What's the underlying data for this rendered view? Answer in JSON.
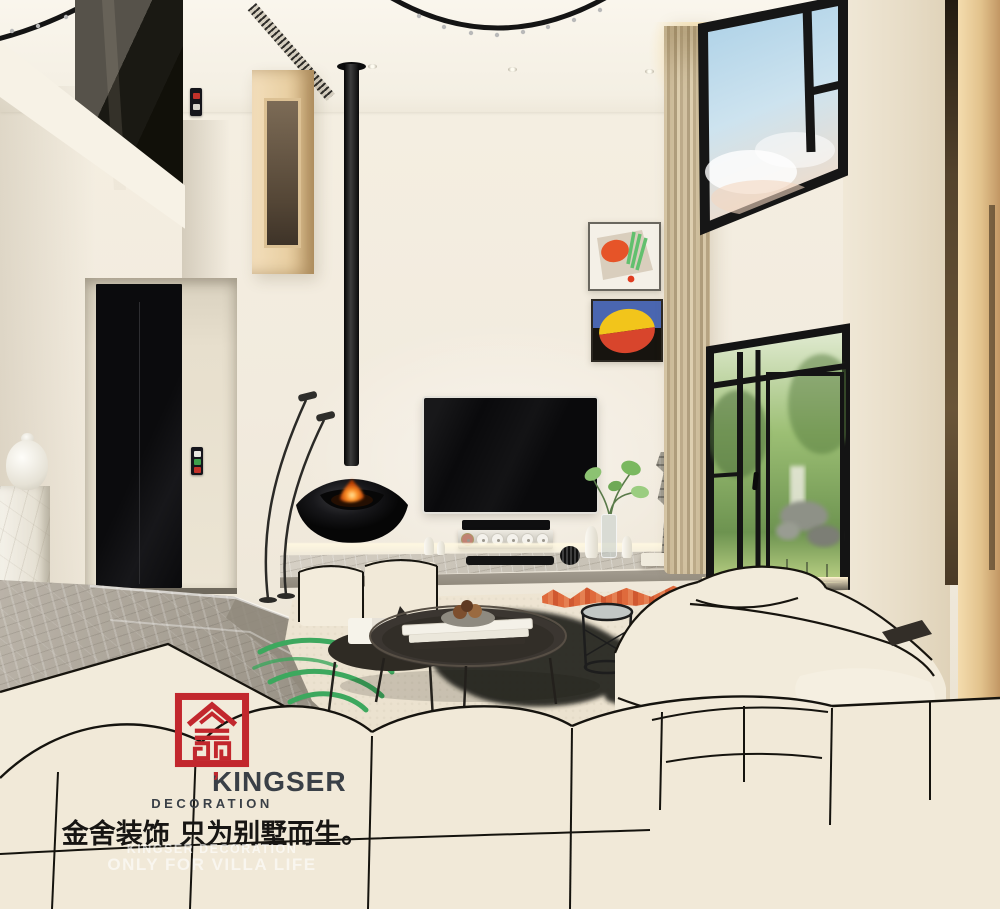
{
  "watermark": {
    "brand": "KINGSER",
    "brand_apostrophe": "’",
    "subtitle": "DECORATION",
    "slogan_cn": "金舍装饰 只为别墅而生。",
    "slogan_en_line1": "KINGSER DECORATION",
    "slogan_en_line2": "ONLY FOR VILLA LIFE",
    "logo_color": "#c2272d"
  },
  "scene": {
    "description": "Modern minimalist double-height villa living room render: suspended black fireplace, wall-mounted TV, cream modular sofa with black piping, marble steps, garden-view black framed windows",
    "colors": {
      "wall": "#f2ebde",
      "ceiling": "#f8f4ea",
      "black_fixture": "#141414",
      "marble_floor": "#a39c90",
      "ledge_marble": "#cfc9bd",
      "wood": "#e2c28c",
      "curtain": "#d8c8a8",
      "rug": "#ece3d1",
      "sofa": "#f2ebdb",
      "fire": "#ff9226",
      "sky": "#b3d4e8",
      "garden": "#8fb468",
      "rug_accent_orange": "#df6a3c",
      "rug_accent_green": "#3da85e",
      "art_blue": "#4a66b0",
      "art_yellow": "#f2c51b",
      "art_red": "#d8452c"
    }
  }
}
